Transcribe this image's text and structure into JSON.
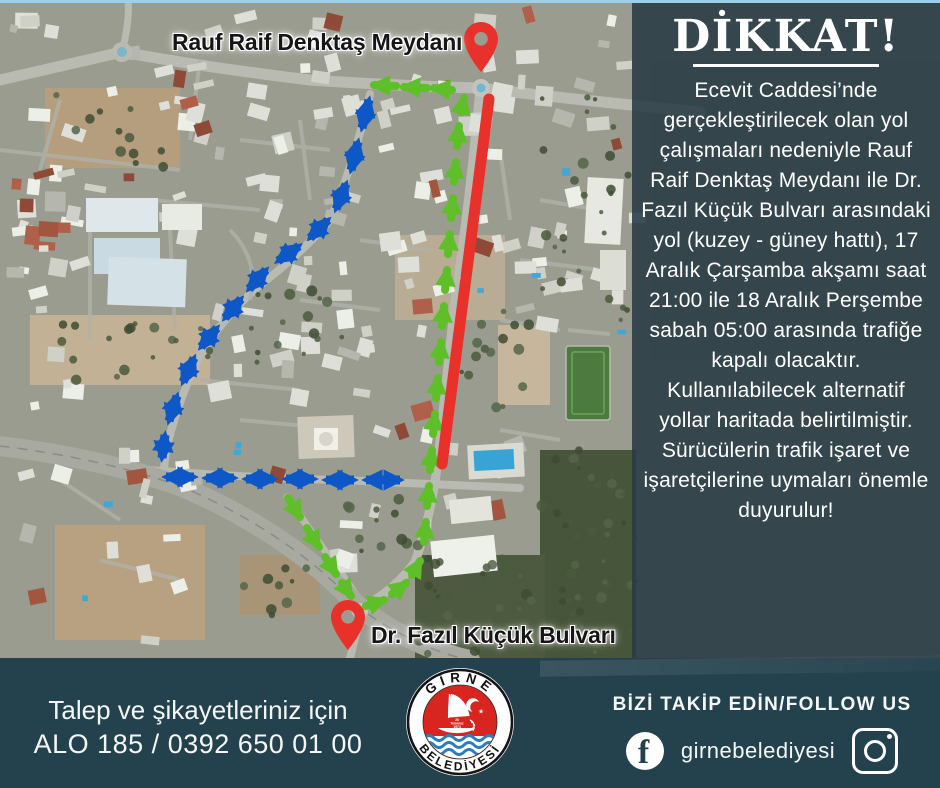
{
  "theme": {
    "accent_red": "#e8312a",
    "route_green": "#5ebf28",
    "route_blue": "#0e57c6",
    "panel_bg": "rgba(41,59,68,0.88)",
    "bar_bg": "#24424e",
    "top_border": "#9ccfe9",
    "label_color": "#161616"
  },
  "map": {
    "pin_top_label": "Rauf Raif Denktaş Meydanı",
    "pin_bottom_label": "Dr. Fazıl Küçük Bulvarı",
    "routes": [
      {
        "name": "closed-road-section",
        "color": "#e8312a",
        "style": "solid-line"
      },
      {
        "name": "alternative-route-east",
        "color": "#5ebf28",
        "style": "one-way-arrows"
      },
      {
        "name": "alternative-route-west",
        "color": "#0e57c6",
        "style": "two-way-arrows"
      }
    ]
  },
  "notice": {
    "title": "DİKKAT!",
    "body": "Ecevit Caddesi’nde gerçekleştirilecek olan yol çalışmaları nedeniyle Rauf Raif Denktaş Meydanı ile Dr. Fazıl Küçük Bulvarı arasındaki yol (kuzey - güney hattı), 17 Aralık Çarşamba akşamı saat 21:00 ile 18 Aralık Perşembe sabah 05:00 arasında trafiğe kapalı olacaktır. Kullanılabilecek alternatif yollar haritada belirtilmiştir. Sürücülerin trafik işaret ve işaretçilerine uymaları önemle duyurulur!"
  },
  "footer": {
    "contact_line1": "Talep ve şikayetleriniz için",
    "contact_line2": "ALO 185 / 0392 650 01 00",
    "follow_label": "BİZİ TAKİP EDİN/FOLLOW US",
    "social_handle": "girnebelediyesi",
    "logo": {
      "top_text": "GİRNE",
      "bottom_text": "BELEDİYESİ",
      "date_top": "20",
      "date_mid": "Temmuz",
      "date_bot": "1974"
    }
  }
}
